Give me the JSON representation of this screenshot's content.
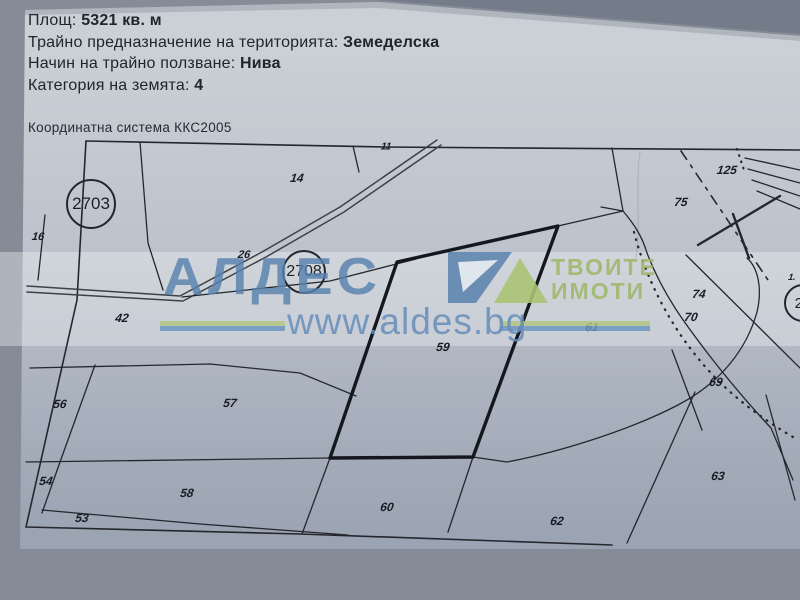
{
  "document": {
    "header_rows": [
      {
        "label": "Площ:",
        "value": "5321 кв. м"
      },
      {
        "label": "Трайно предназначение на територията:",
        "value": "Земеделска"
      },
      {
        "label": "Начин на трайно ползване:",
        "value": "Нива"
      },
      {
        "label": "Категория на земята:",
        "value": "4"
      }
    ],
    "coord_system": "Координатна система ККС2005"
  },
  "map": {
    "subject_parcel": "59",
    "parcels": [
      {
        "id": "11",
        "x": 386,
        "y": 147,
        "s": 10
      },
      {
        "id": "14",
        "x": 297,
        "y": 178
      },
      {
        "id": "125",
        "x": 727,
        "y": 170
      },
      {
        "id": "75",
        "x": 681,
        "y": 202
      },
      {
        "id": "16",
        "x": 38,
        "y": 237,
        "s": 11
      },
      {
        "id": "26",
        "x": 244,
        "y": 255,
        "s": 11
      },
      {
        "id": "1.",
        "x": 792,
        "y": 277,
        "s": 9
      },
      {
        "id": "42",
        "x": 122,
        "y": 318
      },
      {
        "id": "61",
        "x": 592,
        "y": 327
      },
      {
        "id": "59",
        "x": 443,
        "y": 347
      },
      {
        "id": "74",
        "x": 699,
        "y": 294
      },
      {
        "id": "70",
        "x": 691,
        "y": 317
      },
      {
        "id": "56",
        "x": 60,
        "y": 404
      },
      {
        "id": "57",
        "x": 230,
        "y": 403
      },
      {
        "id": "69",
        "x": 716,
        "y": 382
      },
      {
        "id": "63",
        "x": 718,
        "y": 476
      },
      {
        "id": "54",
        "x": 46,
        "y": 481
      },
      {
        "id": "58",
        "x": 187,
        "y": 493
      },
      {
        "id": "60",
        "x": 387,
        "y": 507
      },
      {
        "id": "53",
        "x": 82,
        "y": 518
      },
      {
        "id": "62",
        "x": 557,
        "y": 521
      }
    ],
    "circled_parcels": [
      {
        "id": "2703",
        "x": 91,
        "y": 204,
        "r": 23,
        "f": 17
      },
      {
        "id": "2708",
        "x": 304,
        "y": 272,
        "r": 20,
        "f": 16
      },
      {
        "id": "20",
        "x": 803,
        "y": 303,
        "r": 17,
        "f": 15
      }
    ]
  },
  "watermark": {
    "brand": "АЛДЕС",
    "tagline_line1": "ТВОИТЕ",
    "tagline_line2": "ИМОТИ",
    "url": "www.aldes.bg"
  },
  "colors": {
    "background": "#858c98",
    "paper": "#bcc2cb",
    "map_line": "#24272e",
    "watermark_blue": "#5881ad",
    "watermark_green": "#9eb86a"
  }
}
